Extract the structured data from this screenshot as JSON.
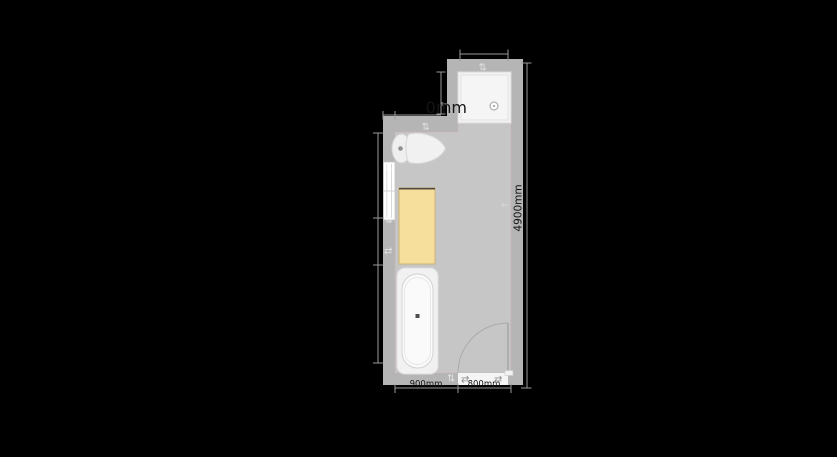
{
  "app": {
    "view": "bathroom-floor-plan-canvas",
    "background_color": "#000000"
  },
  "plan": {
    "room_shape": "L-shaped bathroom",
    "colors": {
      "wall": "#b5b5b5",
      "floor": "#c6c6c6",
      "floor_edge_tint": "rgba(205,180,180,0.7)",
      "fixture_white": "#f0f0f0",
      "shower_tray": "#f2f2f2",
      "cabinet_fill": "#f6df9d",
      "cabinet_border": "#c9b273",
      "window_fill": "#ffffff",
      "dimension_line": "#9a9a9a",
      "dimension_text": "#141414"
    },
    "dimensions": {
      "active_label": "0mm",
      "right_wall_label": "4900mm",
      "bottom_left_label": "900mm",
      "bottom_right_label": "800mm"
    },
    "fixtures": [
      {
        "name": "shower-tray",
        "position": "top-right nook"
      },
      {
        "name": "toilet",
        "position": "top wall, facing right"
      },
      {
        "name": "window",
        "position": "left wall"
      },
      {
        "name": "cabinet",
        "position": "left wall, center"
      },
      {
        "name": "bathtub",
        "position": "bottom-left"
      },
      {
        "name": "door",
        "position": "bottom wall, swings inward, hinge right"
      }
    ],
    "handles": {
      "wall_move_arrow_vertical": "⇅",
      "wall_move_arrow_horizontal": "⇄",
      "wall_move_arrow_left": "←"
    }
  }
}
